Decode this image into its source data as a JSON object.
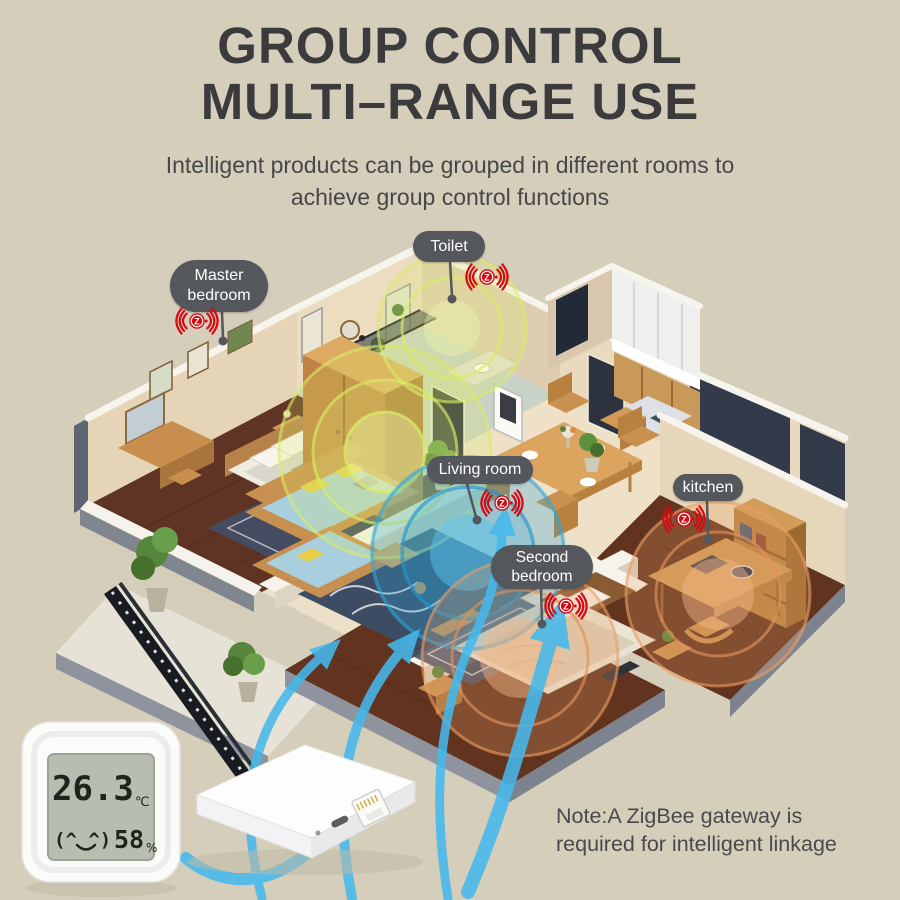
{
  "background_color": "#d5cebb",
  "header": {
    "title_line1": "GROUP CONTROL",
    "title_line2": "MULTI–RANGE USE",
    "subtitle_line1": "Intelligent products can be grouped in different rooms to",
    "subtitle_line2": "achieve group control functions"
  },
  "room_labels": {
    "master_bedroom": {
      "line1": "Master",
      "line2": "bedroom"
    },
    "toilet": {
      "line1": "Toilet"
    },
    "living_room": {
      "line1": "Living room"
    },
    "second_bedroom": {
      "line1": "Second",
      "line2": "bedroom"
    },
    "kitchen": {
      "line1": "kitchen"
    }
  },
  "zigbee_icon": {
    "letter": "Z",
    "color": "#d40b14"
  },
  "sensor_device": {
    "temperature": "26.3",
    "temperature_unit": "℃",
    "face": "(^ ^)",
    "humidity": "58",
    "humidity_unit": "%"
  },
  "note": {
    "line1": "Note:A ZigBee gateway is",
    "line2": "required for intelligent linkage"
  },
  "palette": {
    "title_text": "#3b3b3d",
    "label_pill": "#54575b",
    "zigbee_red": "#d40b14",
    "signal_yellow": "#d9ec66",
    "signal_blue": "#2ba7dd",
    "signal_orange": "#eb9f63",
    "arrow_blue": "#45b9ec",
    "wall_cream": "#e8d7bb",
    "floor_wood": "#5f3424"
  }
}
